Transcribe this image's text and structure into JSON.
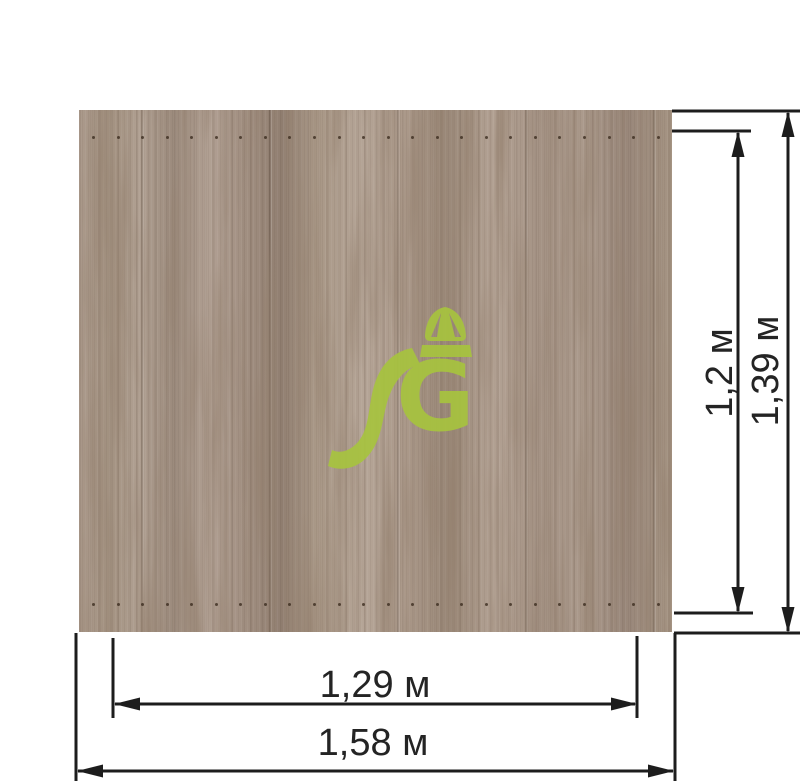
{
  "diagram": {
    "type": "furniture panel dimension drawing",
    "units": "м"
  },
  "dimensions": {
    "height_inner": {
      "label": "1,2 м",
      "value_m": 1.2
    },
    "height_outer": {
      "label": "1,39 м",
      "value_m": 1.39
    },
    "width_inner": {
      "label": "1,29 м",
      "value_m": 1.29
    },
    "width_outer": {
      "label": "1,58 м",
      "value_m": 1.58
    }
  },
  "panel": {
    "material": "wood",
    "hole_rows": [
      {
        "y": 26
      },
      {
        "y": 493
      }
    ],
    "holes_per_row": 24,
    "hole_start_x": 13,
    "hole_spacing": 24.55
  },
  "logo": {
    "letter": "G",
    "color": "#a7c33f",
    "description": "green letter G with swoosh tail and bag handle"
  },
  "colors": {
    "line": "#1d1d1d",
    "wood_base": "#a89786",
    "background": "#ffffff",
    "label_text": "#242424"
  }
}
